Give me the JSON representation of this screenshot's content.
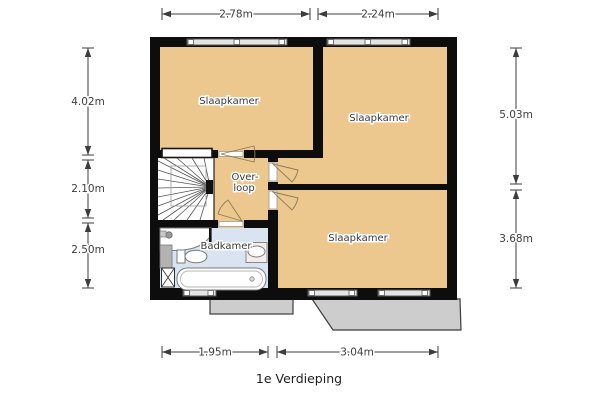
{
  "title": "1e Verdieping",
  "rooms": {
    "slaapkamer_tl": {
      "label": "Slaapkamer"
    },
    "slaapkamer_tr": {
      "label": "Slaapkamer"
    },
    "slaapkamer_br": {
      "label": "Slaapkamer"
    },
    "overloop": {
      "label_line1": "Over-",
      "label_line2": "loop"
    },
    "badkamer": {
      "label": "Badkamer"
    }
  },
  "dims": {
    "top": [
      {
        "label": "2.78m"
      },
      {
        "label": "2.24m"
      }
    ],
    "left": [
      {
        "label": "4.02m"
      },
      {
        "label": "2.10m"
      },
      {
        "label": "2.50m"
      }
    ],
    "right": [
      {
        "label": "5.03m"
      },
      {
        "label": "3.68m"
      }
    ],
    "bottom": [
      {
        "label": "1.95m"
      },
      {
        "label": "3.04m"
      }
    ]
  },
  "colors": {
    "wall": "#0d0d0d",
    "room-fill": "#ecc78e",
    "bath-fill": "#d9e4f0",
    "roof-fill": "#cdcdcd",
    "fixture-fill": "#ffffff",
    "dim-color": "#3d3d3d",
    "label-color": "#3a3a3a"
  }
}
